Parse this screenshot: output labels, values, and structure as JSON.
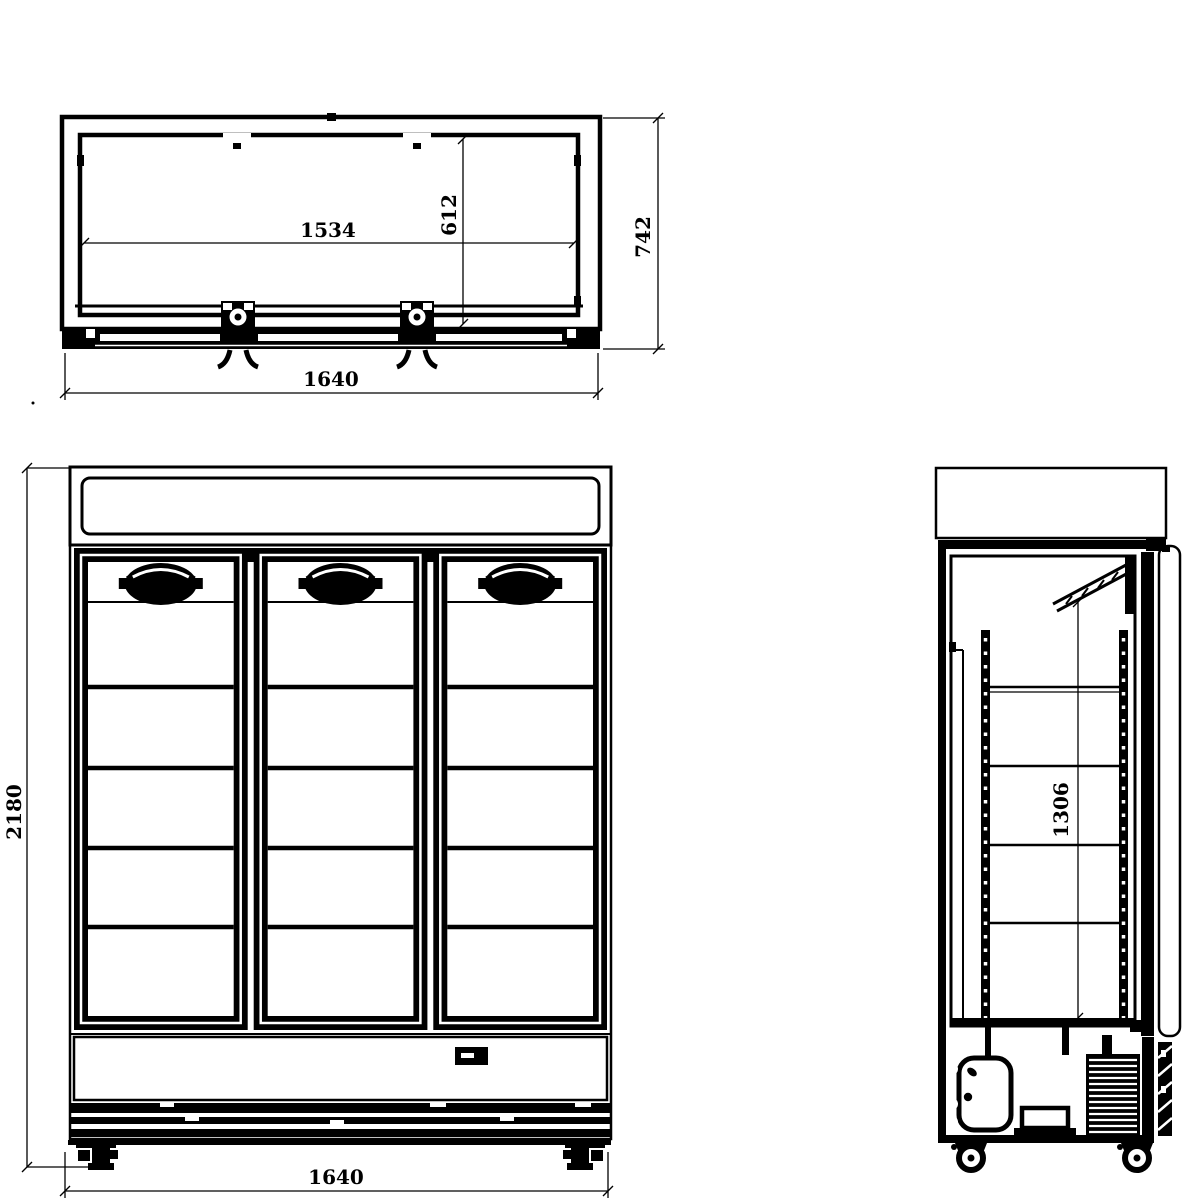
{
  "dimensions": {
    "top_view": {
      "inner_width": "1534",
      "inner_depth": "612",
      "overall_depth": "742",
      "overall_width": "1640"
    },
    "front_view": {
      "overall_height": "2180",
      "overall_width": "1640"
    },
    "side_view": {
      "interior_height": "1306"
    }
  },
  "colors": {
    "line": "#000000",
    "background": "#ffffff"
  }
}
